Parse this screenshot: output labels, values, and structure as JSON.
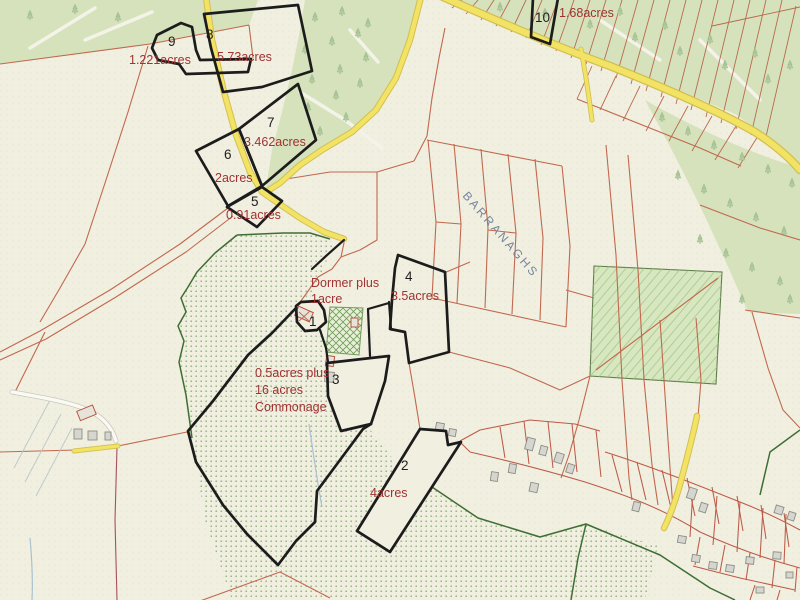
{
  "map": {
    "townland": {
      "name": "BARRANAGHS"
    },
    "parcels": [
      {
        "number": "1",
        "note_line1": "Dormer plus",
        "note_line2": "1acre"
      },
      {
        "number": "2",
        "acreage": "4acres"
      },
      {
        "number": "3",
        "note_line1": "0.5acres plus",
        "note_line2": "16 acres",
        "note_line3": "Commonage"
      },
      {
        "number": "4",
        "acreage": "3.5acres"
      },
      {
        "number": "5",
        "acreage": "0.91acres"
      },
      {
        "number": "6",
        "acreage": "2acres"
      },
      {
        "number": "7",
        "acreage": "3.462acres"
      },
      {
        "number": "8",
        "acreage": "5.73acres"
      },
      {
        "number": "9",
        "acreage": "1.221acres"
      },
      {
        "number": "10",
        "acreage": "1.68acres"
      }
    ],
    "colors": {
      "background": "#f1efe0",
      "parcel_outline_black": "#1c1c1c",
      "acreage_text_red": "#a03232",
      "parcel_number_text": "#1f1f1f",
      "field_boundary_red": "#c1684e",
      "road_yellow": "#f3e364",
      "forest_green": "#d5e2bc",
      "hedge_green": "#3e6e33",
      "commonage_dot_green": "#7da06b",
      "townland_text_blue": "#75849e"
    }
  }
}
